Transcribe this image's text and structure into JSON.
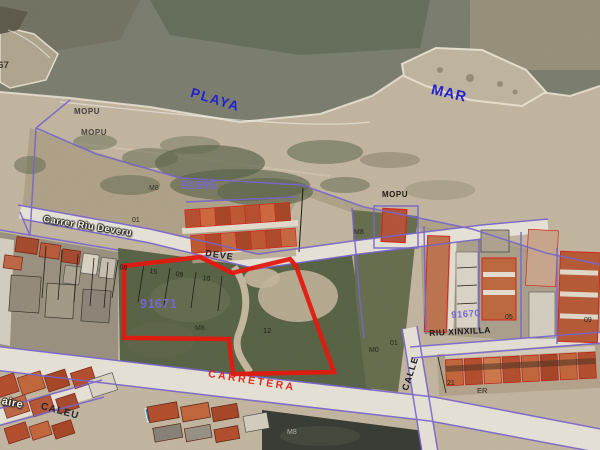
{
  "app": {
    "view": "cadastral-aerial-map"
  },
  "map": {
    "colors": {
      "cadastral_line_purple": "#7a67cf",
      "highlight_parcel_red": "#e8190f",
      "parcel_number_purple": "#7668d2",
      "sea_label_blue": "#2222cc",
      "road_label_red": "#d81c10",
      "road_white": "#e8e4d9",
      "sea": "#7d8071",
      "sand": "#c5b8a3",
      "field_green": "#5a6548"
    },
    "parcel_numbers": [
      "91695",
      "91671",
      "91670"
    ],
    "area_names": [
      "PLAYA",
      "MAR",
      "MOPU"
    ],
    "street_names": [
      "Carrer Riu Deveru",
      "DEVE",
      "CARRETERA",
      "CALLE",
      "RIU XINXILLA",
      "CALEU"
    ]
  },
  "labels": [
    {
      "id": "rock-667",
      "text": "667",
      "x": -7,
      "y": 61,
      "size": 9.5,
      "color": "#3f382c",
      "rot": 0,
      "bold": true,
      "ls": 0
    },
    {
      "id": "mopu-1",
      "text": "MOPU",
      "x": 74,
      "y": 108,
      "size": 8,
      "color": "#44403a",
      "rot": 0,
      "bold": true,
      "ls": 0.5
    },
    {
      "id": "mopu-2",
      "text": "MOPU",
      "x": 81,
      "y": 129,
      "size": 8,
      "color": "#4a443c",
      "rot": 0,
      "bold": true,
      "ls": 0.5
    },
    {
      "id": "playa",
      "text": "PLAYA",
      "x": 193,
      "y": 86,
      "size": 13.5,
      "color": "#2222cc",
      "rot": 17,
      "bold": true,
      "ls": 1.5
    },
    {
      "id": "mar",
      "text": "MAR",
      "x": 433,
      "y": 83,
      "size": 14.5,
      "color": "#2222cc",
      "rot": 13,
      "bold": true,
      "ls": 1
    },
    {
      "id": "parcel-91695",
      "text": "91695",
      "x": 181,
      "y": 179,
      "size": 12,
      "color": "#7668d2",
      "rot": 0,
      "bold": true,
      "ls": 0.5
    },
    {
      "id": "m8-dune",
      "text": "M8",
      "x": 149,
      "y": 185,
      "size": 7,
      "color": "#3a352c",
      "rot": 0,
      "bold": false,
      "ls": 0
    },
    {
      "id": "carrer-riu-deveru",
      "text": "Carrer Riu Deveru",
      "x": 44,
      "y": 215,
      "size": 9.5,
      "color": "#f2efe4",
      "rot": 9,
      "bold": true,
      "ls": 0.5,
      "halo": true
    },
    {
      "id": "num-01-a",
      "text": "01",
      "x": 132,
      "y": 217,
      "size": 7,
      "color": "#2f2a22",
      "rot": 0,
      "bold": false,
      "ls": 0
    },
    {
      "id": "deve",
      "text": "DEVE",
      "x": 206,
      "y": 249,
      "size": 9,
      "color": "#20202c",
      "rot": 8,
      "bold": true,
      "ls": 1
    },
    {
      "id": "mopu-3",
      "text": "MOPU",
      "x": 382,
      "y": 191,
      "size": 8,
      "color": "#1e1a14",
      "rot": 0,
      "bold": true,
      "ls": 0.5
    },
    {
      "id": "m8-mopu",
      "text": "M8",
      "x": 354,
      "y": 229,
      "size": 7,
      "color": "#2a251e",
      "rot": 0,
      "bold": false,
      "ls": 0
    },
    {
      "id": "num-08",
      "text": "08",
      "x": 120,
      "y": 264,
      "size": 7,
      "color": "#1d1a12",
      "rot": 8,
      "bold": false,
      "ls": 0
    },
    {
      "id": "num-15",
      "text": "15",
      "x": 150,
      "y": 268,
      "size": 7,
      "color": "#1d1a12",
      "rot": 8,
      "bold": false,
      "ls": 0
    },
    {
      "id": "num-09",
      "text": "09",
      "x": 176,
      "y": 271,
      "size": 7,
      "color": "#1d1a12",
      "rot": 8,
      "bold": false,
      "ls": 0
    },
    {
      "id": "num-10",
      "text": "10",
      "x": 203,
      "y": 275,
      "size": 7,
      "color": "#1d1a12",
      "rot": 8,
      "bold": false,
      "ls": 0
    },
    {
      "id": "parcel-91671",
      "text": "91671",
      "x": 140,
      "y": 298,
      "size": 12.5,
      "color": "#7668d2",
      "rot": 0,
      "bold": true,
      "ls": 0.5
    },
    {
      "id": "m8-field",
      "text": "M8",
      "x": 195,
      "y": 325,
      "size": 7,
      "color": "#2c2c22",
      "rot": 0,
      "bold": false,
      "ls": 0
    },
    {
      "id": "num-12",
      "text": "12",
      "x": 263,
      "y": 327,
      "size": 7.5,
      "color": "#24241a",
      "rot": 0,
      "bold": false,
      "ls": 0
    },
    {
      "id": "num-m0",
      "text": "M0",
      "x": 369,
      "y": 347,
      "size": 7,
      "color": "#26261c",
      "rot": 0,
      "bold": false,
      "ls": 0
    },
    {
      "id": "num-01-b",
      "text": "01",
      "x": 390,
      "y": 340,
      "size": 7,
      "color": "#26261c",
      "rot": 0,
      "bold": false,
      "ls": 0
    },
    {
      "id": "calle",
      "text": "CALLE",
      "x": 401,
      "y": 389,
      "size": 9,
      "color": "#14141c",
      "rot": -72,
      "bold": true,
      "ls": 1
    },
    {
      "id": "riu-xinxilla",
      "text": "RIU XINXILLA",
      "x": 429,
      "y": 329,
      "size": 8.5,
      "color": "#16161e",
      "rot": -3,
      "bold": true,
      "ls": 0.5
    },
    {
      "id": "parcel-91670",
      "text": "91670",
      "x": 451,
      "y": 311,
      "size": 9.5,
      "color": "#7668d2",
      "rot": -4,
      "bold": true,
      "ls": 0.5
    },
    {
      "id": "num-05",
      "text": "05",
      "x": 505,
      "y": 314,
      "size": 7,
      "color": "#26261c",
      "rot": 0,
      "bold": false,
      "ls": 0
    },
    {
      "id": "num-09-b",
      "text": "09",
      "x": 584,
      "y": 317,
      "size": 7,
      "color": "#26261c",
      "rot": 0,
      "bold": false,
      "ls": 0
    },
    {
      "id": "carretera",
      "text": "CARRETERA",
      "x": 209,
      "y": 369,
      "size": 10.5,
      "color": "#d81c10",
      "rot": 9,
      "bold": true,
      "ls": 2.5,
      "op": 0.92
    },
    {
      "id": "aire",
      "text": "aire",
      "x": 3,
      "y": 396,
      "size": 11,
      "color": "#f4f1e6",
      "rot": 12,
      "bold": true,
      "ls": 0.5,
      "halo": true
    },
    {
      "id": "caleu",
      "text": "CALEU",
      "x": 42,
      "y": 402,
      "size": 10,
      "color": "#232732",
      "rot": 15,
      "bold": true,
      "ls": 1
    },
    {
      "id": "num-21",
      "text": "21",
      "x": 447,
      "y": 380,
      "size": 7,
      "color": "#2a261c",
      "rot": 0,
      "bold": false,
      "ls": 0
    },
    {
      "id": "num-er",
      "text": "ER",
      "x": 477,
      "y": 387,
      "size": 7.5,
      "color": "#2a261c",
      "rot": 0,
      "bold": false,
      "ls": 0
    },
    {
      "id": "m8-bottom",
      "text": "M8",
      "x": 287,
      "y": 429,
      "size": 7,
      "color": "#b6b2a6",
      "rot": 0,
      "bold": false,
      "ls": 0
    }
  ]
}
